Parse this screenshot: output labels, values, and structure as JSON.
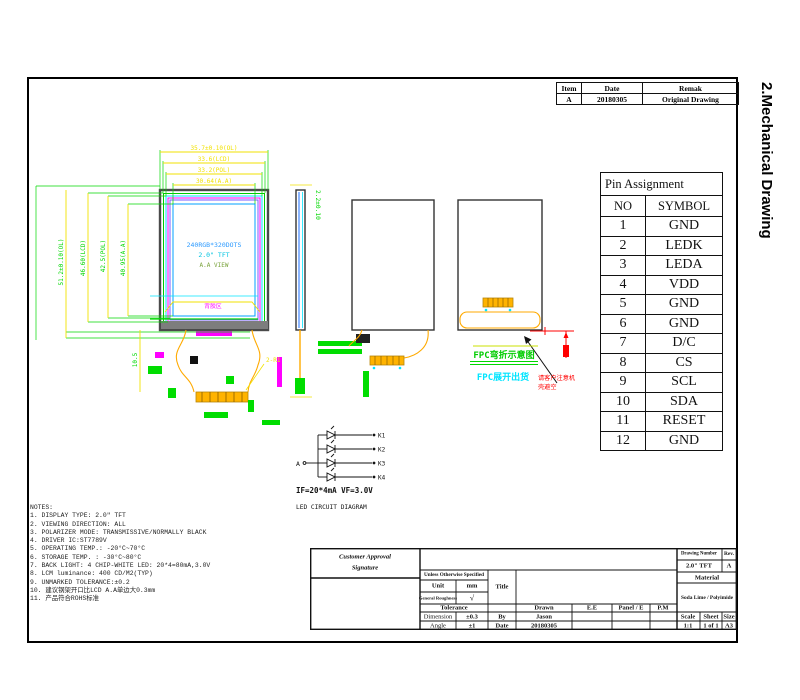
{
  "side_label": "2.Mechanical Drawing",
  "revision_table": {
    "headers": [
      "Item",
      "Date",
      "Remak"
    ],
    "row": [
      "A",
      "20180305",
      "Original Drawing"
    ]
  },
  "pin_table": {
    "title": "Pin Assignment",
    "headers": [
      "NO",
      "SYMBOL"
    ],
    "rows": [
      [
        "1",
        "GND"
      ],
      [
        "2",
        "LEDK"
      ],
      [
        "3",
        "LEDA"
      ],
      [
        "4",
        "VDD"
      ],
      [
        "5",
        "GND"
      ],
      [
        "6",
        "GND"
      ],
      [
        "7",
        "D/C"
      ],
      [
        "8",
        "CS"
      ],
      [
        "9",
        "SCL"
      ],
      [
        "10",
        "SDA"
      ],
      [
        "11",
        "RESET"
      ],
      [
        "12",
        "GND"
      ]
    ]
  },
  "dims": {
    "h": [
      "35.7±0.10(OL)",
      "33.6(LCD)",
      "33.2(POL)",
      "30.64(A.A)"
    ],
    "v": [
      "51.2±0.10(OL)",
      "46.60(LCD)",
      "42.5(POL)",
      "40.95(A.A)"
    ],
    "thickness": "2.2±0.10",
    "fpc_length": "10.5",
    "corner": "2-R1"
  },
  "panel": {
    "resolution": "240RGB*320DOTS",
    "size": "2.0\" TFT",
    "area": "A.A VIEW",
    "adhesive": "背胶区"
  },
  "annotations": {
    "bend": "FPC弯折示意图",
    "flat": "FPC展开出货",
    "warn1": "请客户注意机",
    "warn2": "壳避空"
  },
  "led_circuit": {
    "anode": "A",
    "cathodes": [
      "K1",
      "K2",
      "K3",
      "K4"
    ],
    "spec": "IF=20*4mA  VF=3.0V",
    "caption": "LED CIRCUIT DIAGRAM"
  },
  "notes": {
    "title": "NOTES:",
    "items": [
      "1. DISPLAY TYPE: 2.0\" TFT",
      "2. VIEWING DIRECTION: ALL",
      "3. POLARIZER MODE: TRANSMISSIVE/NORMALLY BLACK",
      "4. DRIVER IC:ST7789V",
      "5. OPERATING TEMP.:  -20°C~70°C",
      "6. STORAGE TEMP. :  -30°C~80°C",
      "7. BACK LIGHT: 4 CHIP-WHITE LED: 20*4=80mA,3.0V",
      "8. LCM luminance: 400 CD/M2(TYP)",
      "9. UNMARKED TOLERANCE:±0.2",
      "10. 建议钢架开口比LCD A.A单边大0.3mm",
      "11. 产品符合ROHS标准"
    ]
  },
  "title_block": {
    "customer1": "Customer Approval",
    "customer2": "Signature",
    "unless": "Unless Otherwise Specified",
    "unit_label": "Unit",
    "unit_value": "mm",
    "roughness_label": "General Roughness",
    "roughness_symbol": "√",
    "title_label": "Title",
    "tolerance_label": "Tolerance",
    "dimension_label": "Dimension",
    "dimension_value": "±0.3",
    "angle_label": "Angle",
    "angle_value": "±1",
    "drawn": "Drawn",
    "ee": "E.E",
    "panel_e": "Panel / E",
    "pm": "P.M",
    "by_label": "By",
    "by_value": "Jason",
    "date_label": "Date",
    "date_value": "20180305",
    "drawing_number_label": "Drawing Number",
    "drawing_number": "2.0\" TFT",
    "rev_label": "Rev.",
    "rev_value": "A",
    "material_label": "Material",
    "material_value": "Soda Lime / Polyimide",
    "scale_label": "Scale",
    "scale_value": "1:1",
    "sheet_label": "Sheet",
    "sheet_value": "1 of 1",
    "size_label": "Size",
    "size_value": "A3"
  },
  "colors": {
    "dim_yellow": "#f2e200",
    "dim_green": "#00d800",
    "fpc_orange": "#ffaa00",
    "magenta": "#ff00ff",
    "cyan": "#00e5ff",
    "warning_red": "#ff0000"
  }
}
